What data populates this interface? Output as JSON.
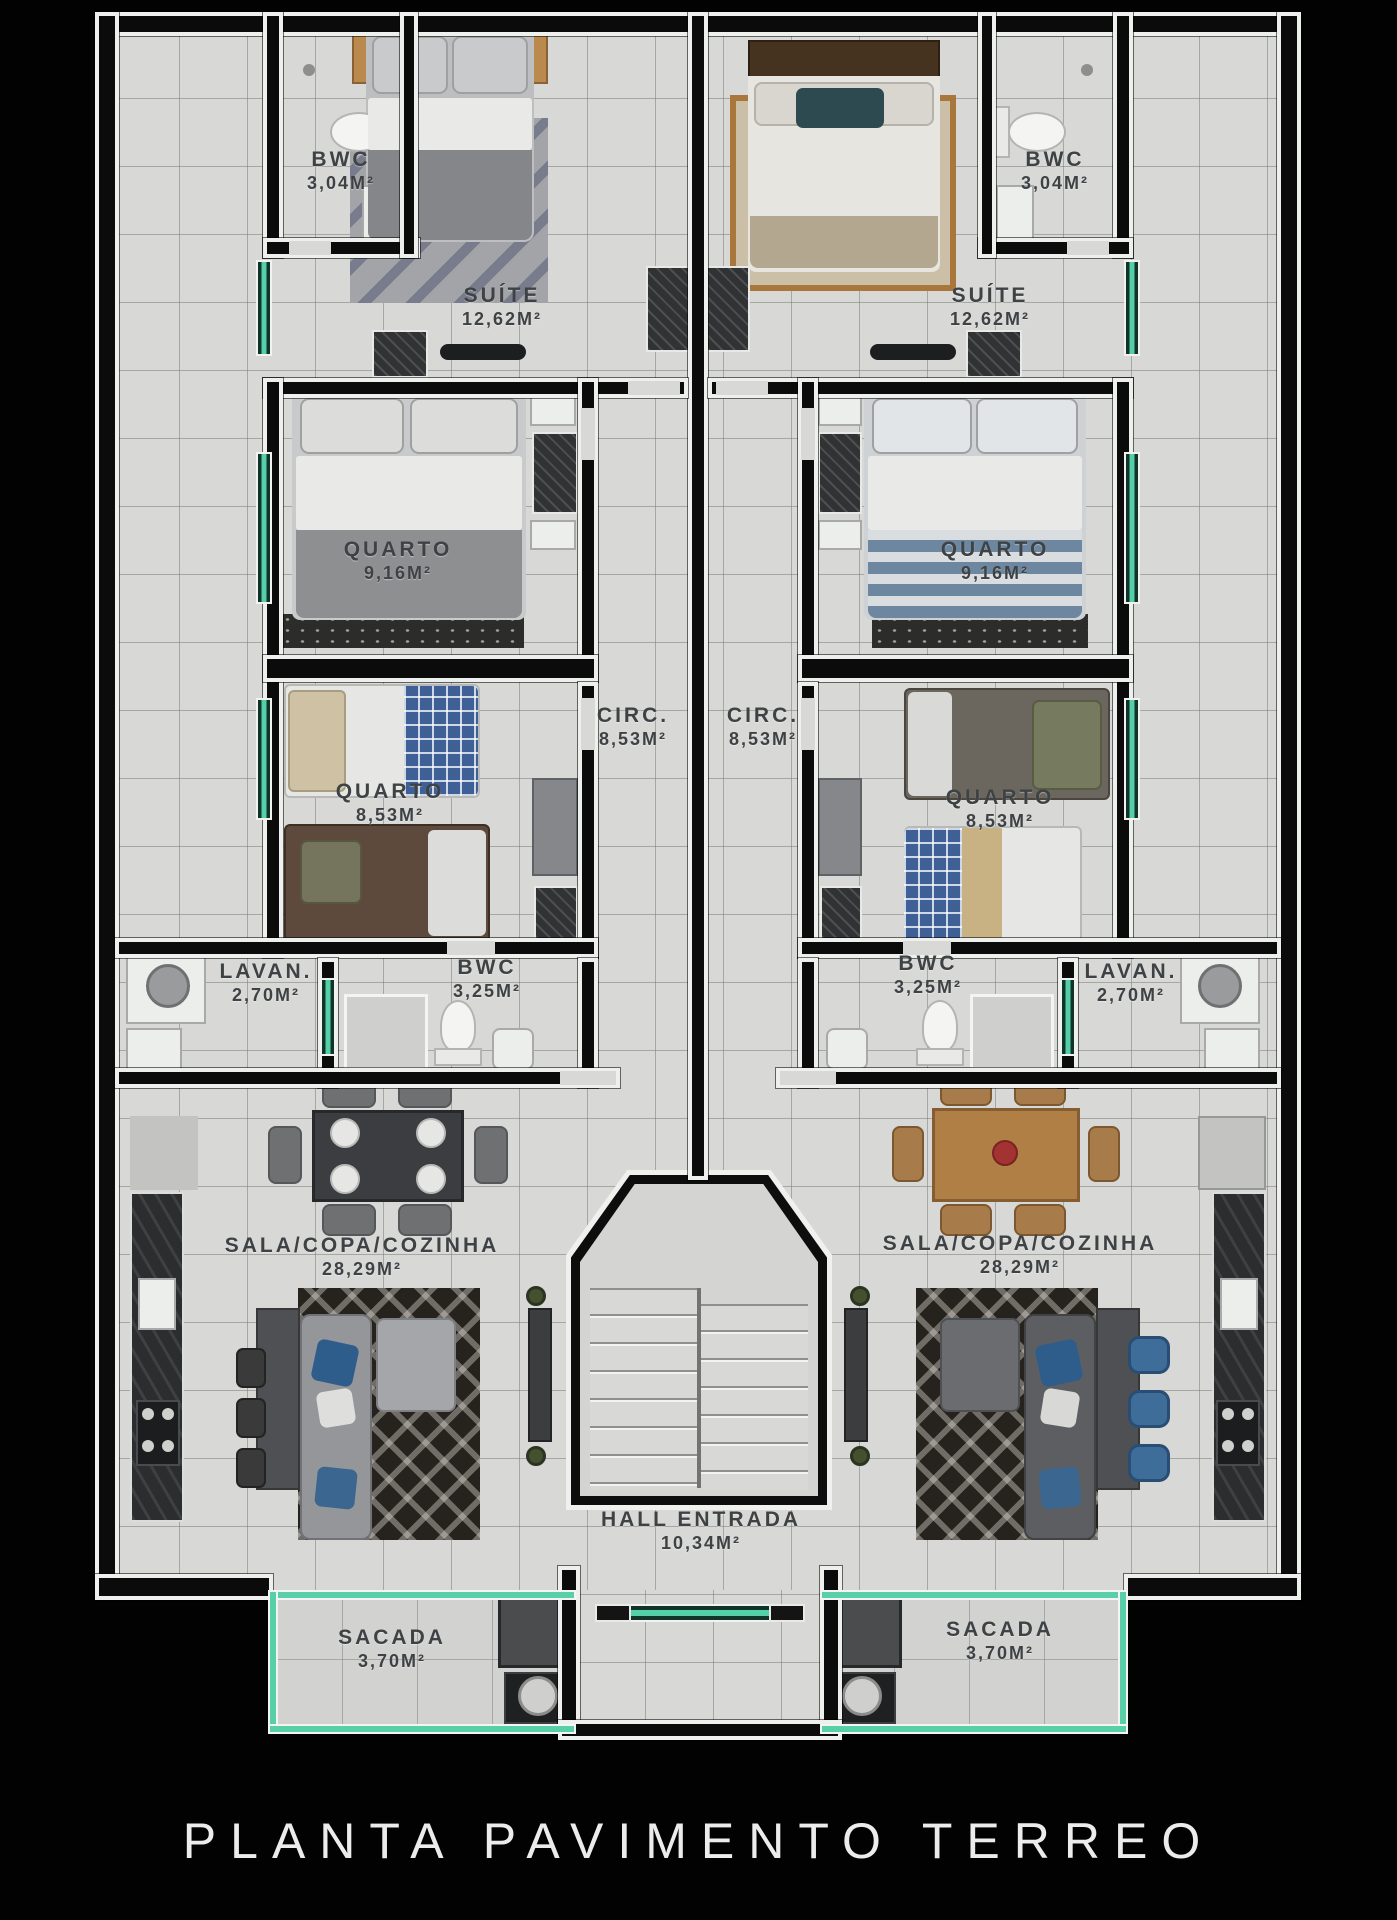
{
  "title": "PLANTA PAVIMENTO TERREO",
  "rooms": {
    "left": {
      "bwc_suite": {
        "name": "BWC",
        "area": "3,04M²"
      },
      "suite": {
        "name": "SUÍTE",
        "area": "12,62M²"
      },
      "quarto1": {
        "name": "QUARTO",
        "area": "9,16M²"
      },
      "circ": {
        "name": "CIRC.",
        "area": "8,53M²"
      },
      "quarto2": {
        "name": "QUARTO",
        "area": "8,53M²"
      },
      "lavan": {
        "name": "LAVAN.",
        "area": "2,70M²"
      },
      "bwc": {
        "name": "BWC",
        "area": "3,25M²"
      },
      "sala": {
        "name": "SALA/COPA/COZINHA",
        "area": "28,29M²"
      },
      "sacada": {
        "name": "SACADA",
        "area": "3,70M²"
      }
    },
    "right": {
      "bwc_suite": {
        "name": "BWC",
        "area": "3,04M²"
      },
      "suite": {
        "name": "SUÍTE",
        "area": "12,62M²"
      },
      "quarto1": {
        "name": "QUARTO",
        "area": "9,16M²"
      },
      "circ": {
        "name": "CIRC.",
        "area": "8,53M²"
      },
      "quarto2": {
        "name": "QUARTO",
        "area": "8,53M²"
      },
      "lavan": {
        "name": "LAVAN.",
        "area": "2,70M²"
      },
      "bwc": {
        "name": "BWC",
        "area": "3,25M²"
      },
      "sala": {
        "name": "SALA/COPA/COZINHA",
        "area": "28,29M²"
      },
      "sacada": {
        "name": "SACADA",
        "area": "3,70M²"
      }
    },
    "hall": {
      "name": "HALL ENTRADA",
      "area": "10,34M²"
    }
  },
  "colors": {
    "background": "#000000",
    "wall": "#0b0b0b",
    "floor": "#d8d9d6",
    "window_accent": "#55cfa7",
    "label_text": "#3f4245",
    "title_text": "#ececec"
  }
}
